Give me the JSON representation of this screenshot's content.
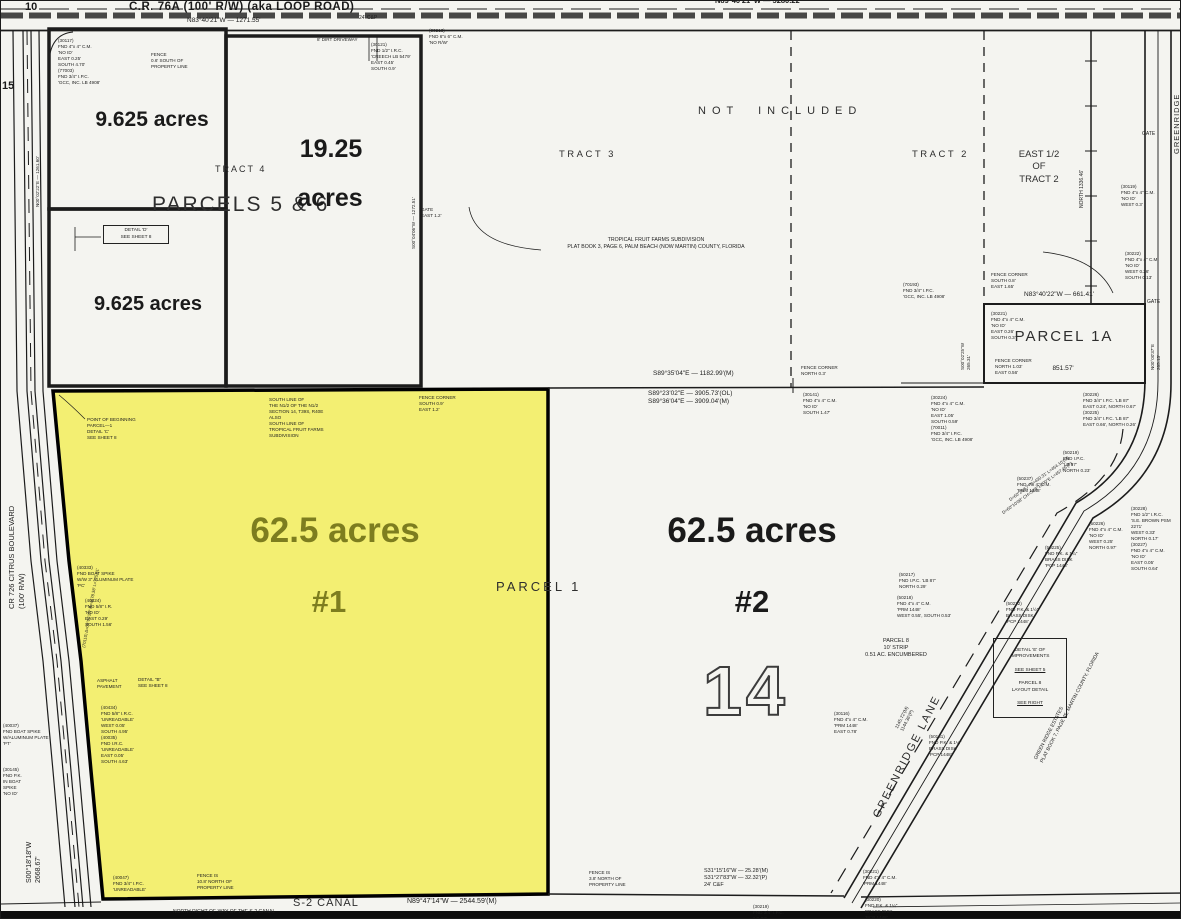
{
  "colors": {
    "highlight": "#f3ef72",
    "acreage_olive": "#7d7d1f",
    "ink": "#1a1a1a",
    "bg": "#f4f4f0"
  },
  "map": {
    "roads": {
      "cr76a": "C.R. 76A  (100' R/W)  (aka LOOP ROAD)",
      "cr76a_bearing": "N83°40'21\"W  —  1271.55'",
      "top_right_bearing": "N89°40'21\"W  —  5280.22'",
      "s2_canal": "S-2 CANAL",
      "s2_bearing": "N89°47'14\"W  —  2544.59'(M)"
    },
    "areas": {
      "not_included": "NOT   INCLUDED",
      "tract_3": "TRACT 3",
      "tract_2": "TRACT 2",
      "tract_4": "TRACT 4",
      "east_half": "EAST 1/2\nOF\nTRACT 2",
      "parcels56": "PARCELS 5 & 6",
      "parcel1": "PARCEL 1",
      "parcel1a": "PARCEL 1A",
      "parcel1a_bearing": "N83°40'22\"W — 661.41'",
      "parcel1a_dim": "851.57'"
    },
    "acreage": {
      "small1": "9.625 acres",
      "small2": "9.625  acres",
      "mid_value": "19.25",
      "mid_unit": "acres",
      "big1": "62.5 acres",
      "big1_num": "#1",
      "big2": "62.5 acres",
      "big2_num": "#2"
    },
    "labels": {
      "section_number": "14",
      "corner_10": "10",
      "corner_15": "15",
      "gate_a": "GATE",
      "gate_b": "GATE"
    },
    "details": {
      "d_box": "DETAIL 'D'\nSEE SHEET 8",
      "e1": "DETAIL 'E' OF\nIMPROVEMENTS",
      "e2": "SEE SHEET 5",
      "e3": "PARCEL 8\nLAYOUT DETAIL",
      "e4": "SEE RIGHT"
    },
    "annotations": [
      {
        "name": "monument-note",
        "t": "(30117)\nFND 4\"x 4\" C.M.\n'NO ID'\nEAST 0.25'\nSOUTH 4.70'\n(77003)\nFND 3/4\" I.P.C.\n'GCC, INC. LB 4908'",
        "x": 57,
        "y": 37
      },
      {
        "name": "fence-note",
        "t": "FENCE\n0.6' SOUTH OF\nPROPERTY LINE",
        "x": 150,
        "y": 51
      },
      {
        "name": "driveway-note",
        "t": "8' DIRT DRIVEWAY",
        "x": 316,
        "y": 36
      },
      {
        "name": "monument-note",
        "t": "(30121)\nFND 1/2\" I.R.C.\n'CREECH LB 5479'\nEAST 0.45'\nSOUTH 0.9'",
        "x": 370,
        "y": 41
      },
      {
        "name": "monument-note",
        "t": "(30213)\nFND 6\"x 6\" C.M.\n'NO R/W'",
        "x": 428,
        "y": 27
      },
      {
        "name": "road-note",
        "t": "24' C&P",
        "x": 358,
        "y": 14,
        "size": 5
      },
      {
        "name": "monument-note",
        "t": "(30119)\nFND 4\"x 4\" C.M.\n'NO ID'\nWEST 0.3'",
        "x": 1120,
        "y": 183
      },
      {
        "name": "gate-note",
        "t": "GATE\nEAST 1.2'",
        "x": 420,
        "y": 206
      },
      {
        "name": "subdivision-note",
        "t": "TROPICAL FRUIT FARMS SUBDIVISION\nPLAT BOOK 3, PAGE 6, PALM BEACH (NOW MARTIN) COUNTY, FLORIDA",
        "x": 655,
        "y": 236,
        "al": "c",
        "size": 5.2
      },
      {
        "name": "monument-note",
        "t": "(70193)\nFND 3/4\" I.P.C.\n'GCC, INC. LB 4908'",
        "x": 902,
        "y": 281
      },
      {
        "name": "fence-note",
        "t": "FENCE CORNER\nSOUTH 0.8'\nEAST 1.65'",
        "x": 990,
        "y": 271
      },
      {
        "name": "monument-note",
        "t": "(30222)\nFND 4\"x 4\" C.M.\n'NO ID'\nWEST 0.26'\nSOUTH 0.13'",
        "x": 1124,
        "y": 250
      },
      {
        "name": "monument-note",
        "t": "(30221)\nFND 4\"x 4\" C.M.\n'NO ID'\nEAST 0.26'\nSOUTH 0.3'",
        "x": 990,
        "y": 310
      },
      {
        "name": "fence-note",
        "t": "FENCE CORNER\nNORTH 1.03'\nEAST 0.56'",
        "x": 994,
        "y": 357
      },
      {
        "name": "monument-note",
        "t": "(30224)\nFND 4\"x 4\" C.M.\n'NO ID'\nEAST 1.05'\nSOUTH 0.59'\n(70011)\nFND 3/4\" I.P.C.\n'GCC, INC. LB 4908'",
        "x": 930,
        "y": 394
      },
      {
        "name": "monument-note",
        "t": "(30226)\nFND 3/4\" I.P.C. 'LB 87'\nEAST 0.24', NORTH 0.67'\n(30225)\nFND 3/4\" I.P.C. 'LB 87'\nEAST 0.66', NORTH 0.26'",
        "x": 1082,
        "y": 391
      },
      {
        "name": "fence-note",
        "t": "FENCE CORNER\nNORTH 0.3'",
        "x": 800,
        "y": 364
      },
      {
        "name": "monument-note",
        "t": "(30141)\nFND 4\"x 4\" C.M.\n'NO ID'\nSOUTH 1.47'",
        "x": 802,
        "y": 391
      },
      {
        "name": "bearing-label",
        "t": "S89°35'04\"E — 1182.99'(M)",
        "x": 652,
        "y": 369,
        "size": 6.5
      },
      {
        "name": "bearing-label",
        "t": "S89°23'02\"E — 3905.73'(OL)\nS89°36'04\"E — 3909.04'(M)",
        "x": 647,
        "y": 389,
        "size": 6.5
      },
      {
        "name": "section-line-note",
        "t": "SOUTH LINE OF\nTHE N1/2 OF THE N1/2\nSECTION 14, T39S, R40E\nALSO\nSOUTH LINE OF\nTROPICAL FRUIT FARMS\nSUBDIVISION",
        "x": 268,
        "y": 396
      },
      {
        "name": "fence-note",
        "t": "FENCE CORNER\nSOUTH 0.9'\nEAST 1.2'",
        "x": 418,
        "y": 394
      },
      {
        "name": "pob-note",
        "t": "POINT OF BEGINNING\nPARCEL—1\nDETAIL 'C'\nSEE SHEET 8",
        "x": 86,
        "y": 416
      },
      {
        "name": "monument-note",
        "t": "(40333)\nFND BOAT SPIKE\nW/W 3\" ALUMINUM PLATE\n'PC'",
        "x": 76,
        "y": 564
      },
      {
        "name": "monument-note",
        "t": "(40424)\nFND 5/8\" I.R.\n'NO ID'\nEAST 0.29'\nSOUTH 1.56'",
        "x": 84,
        "y": 597
      },
      {
        "name": "pavement-note",
        "t": "ASPHALT\nPAVEMENT",
        "x": 96,
        "y": 677
      },
      {
        "name": "detail-note",
        "t": "DETAIL \"B\"\nSEE SHEET 8",
        "x": 137,
        "y": 676
      },
      {
        "name": "monument-note",
        "t": "(40434)\nFND 5/8\" I.R.C.\n'UNREADABLE'\nWEST 0.05'\nSOUTH 4.95'\n(40035)\nFND I.R.C.\n'UNREADABLE'\nEAST 0.05'\nSOUTH 4.63'",
        "x": 100,
        "y": 704
      },
      {
        "name": "monument-note",
        "t": "(40037)\nFND BOAT SPIKE\nW/ALUMINUM PLATE\n'PT'",
        "x": 2,
        "y": 722
      },
      {
        "name": "monument-note",
        "t": "(30145)\nFND P.K.\nIN BOAT\nSPIKE\n'NO ID'",
        "x": 2,
        "y": 766
      },
      {
        "name": "monument-note",
        "t": "(40047)\nFND 3/4\" I.P.C.\n'UNREADABLE'",
        "x": 112,
        "y": 874
      },
      {
        "name": "fence-note",
        "t": "FENCE IS\n10.8' NORTH OF\nPROPERTY LINE",
        "x": 196,
        "y": 872
      },
      {
        "name": "canal-row-note",
        "t": "NORTH RIGHT-OF-WAY OF THE S-2 CANAL",
        "x": 172,
        "y": 908,
        "size": 5
      },
      {
        "name": "fence-note",
        "t": "FENCE IS\n3.8' NORTH OF\nPROPERTY LINE",
        "x": 588,
        "y": 869
      },
      {
        "name": "bearing-label",
        "t": "S31°15'16\"W — 25.28'(M)\nS31°27'83\"W — 32.32'(P)\n24' C&F",
        "x": 703,
        "y": 867,
        "size": 5.5
      },
      {
        "name": "monument-note",
        "t": "(30219)\nFND 3/4\" I.P.C.\n'LB 87'",
        "x": 752,
        "y": 903
      },
      {
        "name": "monument-note",
        "t": "(30221)\nFND 4\"x 4\" C.M.\n'PRM 1448'",
        "x": 862,
        "y": 868
      },
      {
        "name": "monument-note",
        "t": "(30220)\nFND P.K. & 1¼\"\nBRASS DISK\n'PCP 1448'",
        "x": 864,
        "y": 896
      },
      {
        "name": "parcel8-note",
        "t": "PARCEL 8\n10' STRIP\n0.51 AC. ENCUMBERED",
        "x": 895,
        "y": 637,
        "al": "c",
        "size": 5.5
      },
      {
        "name": "monument-note",
        "t": "(50232)\nFND P.K. & 1½\"\nBRASS DISK\n'PCP 1448'",
        "x": 1005,
        "y": 600
      },
      {
        "name": "monument-note",
        "t": "(50219)\nFND I.P.C.\n'LB 87'\nNORTH 0.23'",
        "x": 1062,
        "y": 449
      },
      {
        "name": "monument-note",
        "t": "(50237)\nFND 4\"x 4\" C.M.\n'PRM 1448'",
        "x": 1016,
        "y": 475
      },
      {
        "name": "monument-note",
        "t": "(50226)\nFND 4\"x 4\" C.M.\n'NO ID'\nWEST 0.25'\nNORTH 0.97'",
        "x": 1088,
        "y": 520
      },
      {
        "name": "monument-note",
        "t": "(50225)\nFND P.K. & 1¼\"\nBRASS DISK\n'PCP 1448'",
        "x": 1044,
        "y": 544
      },
      {
        "name": "monument-note",
        "t": "(30228)\nFND 1/2\" I.R.C.\n'S.E. BROWN PSM 2271'\nWEST 0.33'\nNORTH 0.17'\n(30227)\nFND 4\"x 4\" C.M.\n'NO ID'\nEAST 0.05'\nSOUTH 0.64'",
        "x": 1130,
        "y": 505
      },
      {
        "name": "monument-note",
        "t": "(50217)\nFND I.P.C. 'LB 87'\nNORTH 0.29'",
        "x": 898,
        "y": 571
      },
      {
        "name": "monument-note",
        "t": "(50218)\nFND 4\"x 4\" C.M.\n'PRM 1448'\nWEST 0.55', SOUTH 0.53'",
        "x": 896,
        "y": 594
      },
      {
        "name": "monument-note",
        "t": "(30116)\nFND 4\"x 4\" C.M.\n'PRM 1448'\nEAST 0.78'",
        "x": 833,
        "y": 710
      },
      {
        "name": "monument-note",
        "t": "(50131)\nFND P.K. & 1¼\"\nBRASS DISK\n'PCP 1448'",
        "x": 928,
        "y": 733
      },
      {
        "name": "curve-data",
        "t": "D=60°26'57\"  R=430.31'  L=454.10'(M)",
        "x": 1007,
        "y": 497,
        "rot": -36,
        "size": 4.4
      },
      {
        "name": "curve-data",
        "t": "D=60°10'08\"  CH=S58°10'00\"E  L=457.45'(P)",
        "x": 1000,
        "y": 510,
        "rot": -36,
        "size": 4.4
      },
      {
        "name": "bearing-label",
        "t": "1145.72'(M)\n1144.36'(P)",
        "x": 893,
        "y": 726,
        "rot": -63,
        "size": 4.6
      },
      {
        "name": "greenridge-lane-label",
        "t": "GREENRIDGE LANE",
        "x": 869,
        "y": 813,
        "rot": -63,
        "size": 11,
        "ls": 2,
        "color": "#2a2a2a"
      },
      {
        "name": "plat-reference",
        "t": "GREEN RIDGE ESTATES\nPLAT BOOK 7, PAGE 45, MARTIN COUNTY, FLORIDA",
        "x": 1032,
        "y": 757,
        "rot": -63,
        "size": 5
      },
      {
        "name": "citrus-boulevard-label",
        "t": "CR 726 CITRUS BOULEVARD\n(100' R/W)",
        "x": 6,
        "y": 608,
        "rot": -90,
        "size": 7.5
      },
      {
        "name": "bearing-label",
        "t": "S00°18'18\"W\n2668.67'",
        "x": 24,
        "y": 882,
        "rot": -90,
        "size": 7
      },
      {
        "name": "bearing-label",
        "t": "NORTH 1336.46'",
        "x": 1078,
        "y": 207,
        "rot": -90,
        "size": 5
      },
      {
        "name": "bearing-label",
        "t": "S00°02'25\"W\n265.31'",
        "x": 959,
        "y": 369,
        "rot": -90,
        "size": 4.6
      },
      {
        "name": "bearing-label",
        "t": "N00°00'37\"E\n265.13'",
        "x": 1149,
        "y": 369,
        "rot": -90,
        "size": 4.6
      },
      {
        "name": "greenridge-lane-label",
        "t": "GREENRIDGE LANE",
        "x": 1171,
        "y": 153,
        "rot": -90,
        "size": 7.5,
        "ls": 1
      },
      {
        "name": "bearing-label",
        "t": "N00°02'22\"E — 1261.60'",
        "x": 34,
        "y": 206,
        "rot": -90,
        "size": 4.6
      },
      {
        "name": "bearing-label",
        "t": "S00°04'06\"W — 1272.51'",
        "x": 410,
        "y": 248,
        "rot": -90,
        "size": 4.6
      },
      {
        "name": "curve-data",
        "t": "(70110)  Δ=09°05'20\"  R=4578.38'  L=725.81'",
        "x": 80,
        "y": 646,
        "rot": -80,
        "size": 4.2
      }
    ]
  }
}
